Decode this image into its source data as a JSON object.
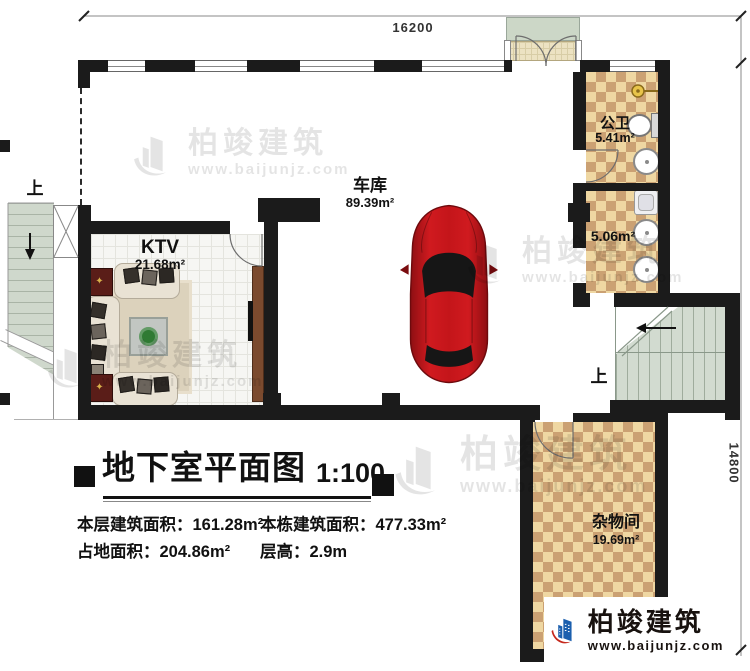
{
  "dimensions": {
    "top": "16200",
    "right": "14800"
  },
  "rooms": {
    "garage": {
      "label": "车库",
      "area": "89.39m²"
    },
    "ktv": {
      "label": "KTV",
      "area": "21.68m²"
    },
    "bathroom": {
      "label": "公卫",
      "area": "5.41m²"
    },
    "washroom": {
      "area": "5.06m²"
    },
    "storage": {
      "label": "杂物间",
      "area": "19.69m²"
    }
  },
  "annotations": {
    "stair_up_left": "上",
    "stair_up_right": "上"
  },
  "title_block": {
    "title": "地下室平面图",
    "scale": "1:100",
    "stats": [
      {
        "label": "本层建筑面积：",
        "value": "161.28m²"
      },
      {
        "label": "本栋建筑面积：",
        "value": "477.33m²"
      },
      {
        "label": "占地面积：",
        "value": "204.86m²"
      },
      {
        "label": "层高：",
        "value": "2.9m"
      }
    ]
  },
  "branding": {
    "company": "柏竣建筑",
    "website": "www.baijunjz.com"
  },
  "watermark": {
    "company": "柏竣建筑",
    "website": "www.baijunjz.com"
  },
  "colors": {
    "wall": "#1b1b1b",
    "checker_light": "#efd7a2",
    "checker_dark": "#cba173",
    "stair_green": "#d2dbd0",
    "car_red": "#b51418",
    "logo_blue": "#1b5fae",
    "logo_red": "#c5281c"
  }
}
